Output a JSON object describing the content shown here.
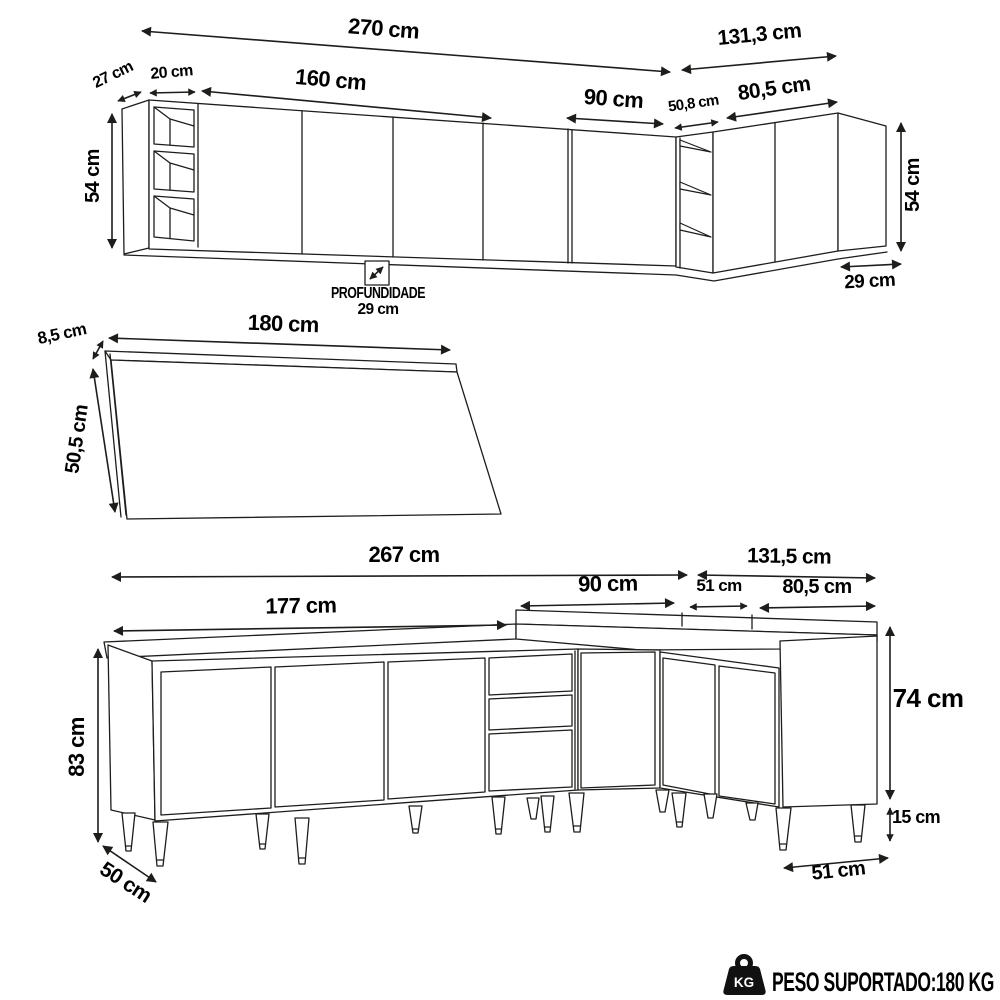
{
  "diagram": {
    "upper": {
      "dim_total_width": "270 cm",
      "dim_right_width": "131,3 cm",
      "dim_side_depth": "27 cm",
      "dim_shelf_width": "20 cm",
      "dim_doors_width": "160 cm",
      "dim_door_width": "90 cm",
      "dim_corner_width": "50,8 cm",
      "dim_right_doors_width": "80,5 cm",
      "dim_height_left": "54 cm",
      "dim_height_right": "54 cm",
      "dim_depth_right": "29 cm",
      "depth_note_title": "PROFUNDIDADE",
      "depth_note_value": "29 cm"
    },
    "countertop": {
      "dim_thickness": "8,5 cm",
      "dim_width": "180 cm",
      "dim_depth": "50,5 cm"
    },
    "base": {
      "dim_total_width": "267 cm",
      "dim_right_width": "131,5 cm",
      "dim_doors_width": "177 cm",
      "dim_back_left": "90 cm",
      "dim_back_corner": "51 cm",
      "dim_back_right": "80,5 cm",
      "dim_total_height": "83 cm",
      "dim_body_height": "74 cm",
      "dim_leg_height": "15 cm",
      "dim_depth_left": "50 cm",
      "dim_depth_right": "51 cm"
    },
    "footer": {
      "icon_label": "KG",
      "text": "PESO SUPORTADO:180 KG"
    },
    "colors": {
      "line": "#1d1d1b",
      "text": "#000000",
      "background": "#ffffff"
    }
  }
}
